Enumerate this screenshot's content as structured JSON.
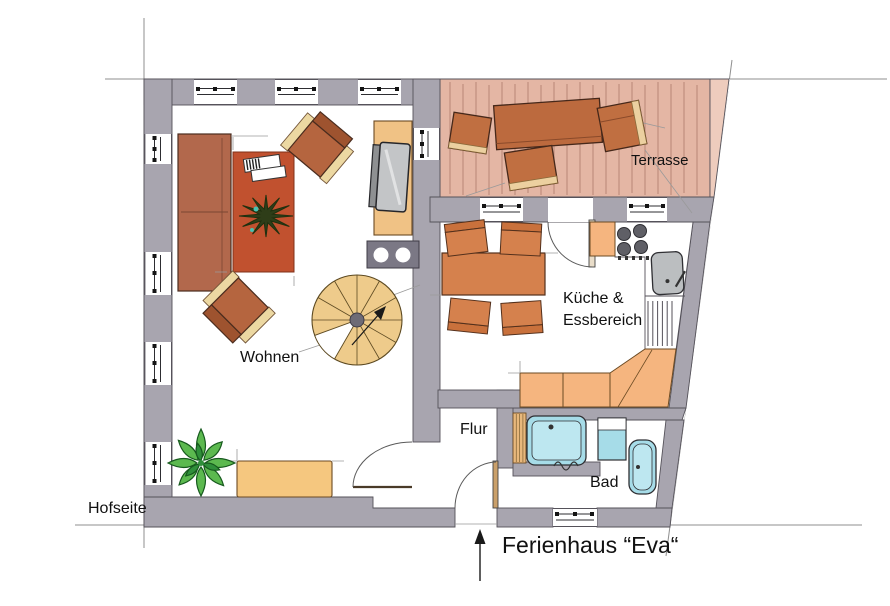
{
  "plan": {
    "title": "Ferienhaus “Eva“",
    "rooms": {
      "living": "Wohnen",
      "kitchen_line1": "Küche &",
      "kitchen_line2": "Essbereich",
      "hall": "Flur",
      "bath": "Bad",
      "terrace": "Terrasse"
    },
    "outside": {
      "courtyard_side": "Hofseite"
    },
    "palette": {
      "wall_gray": "#a8a5af",
      "deck_pink": "#e4b6a4",
      "deck_light": "#eeccbd",
      "wood_brown": "#bc6a3e",
      "rug_red": "#c1512f",
      "counter_orange": "#f5b57f",
      "stair_tan": "#eecb8b",
      "fixture_blue": "#a6dce8",
      "plant_green": "#5cb94f",
      "cabinet_tan": "#f0c285",
      "line_black": "#1a1a1a"
    }
  }
}
